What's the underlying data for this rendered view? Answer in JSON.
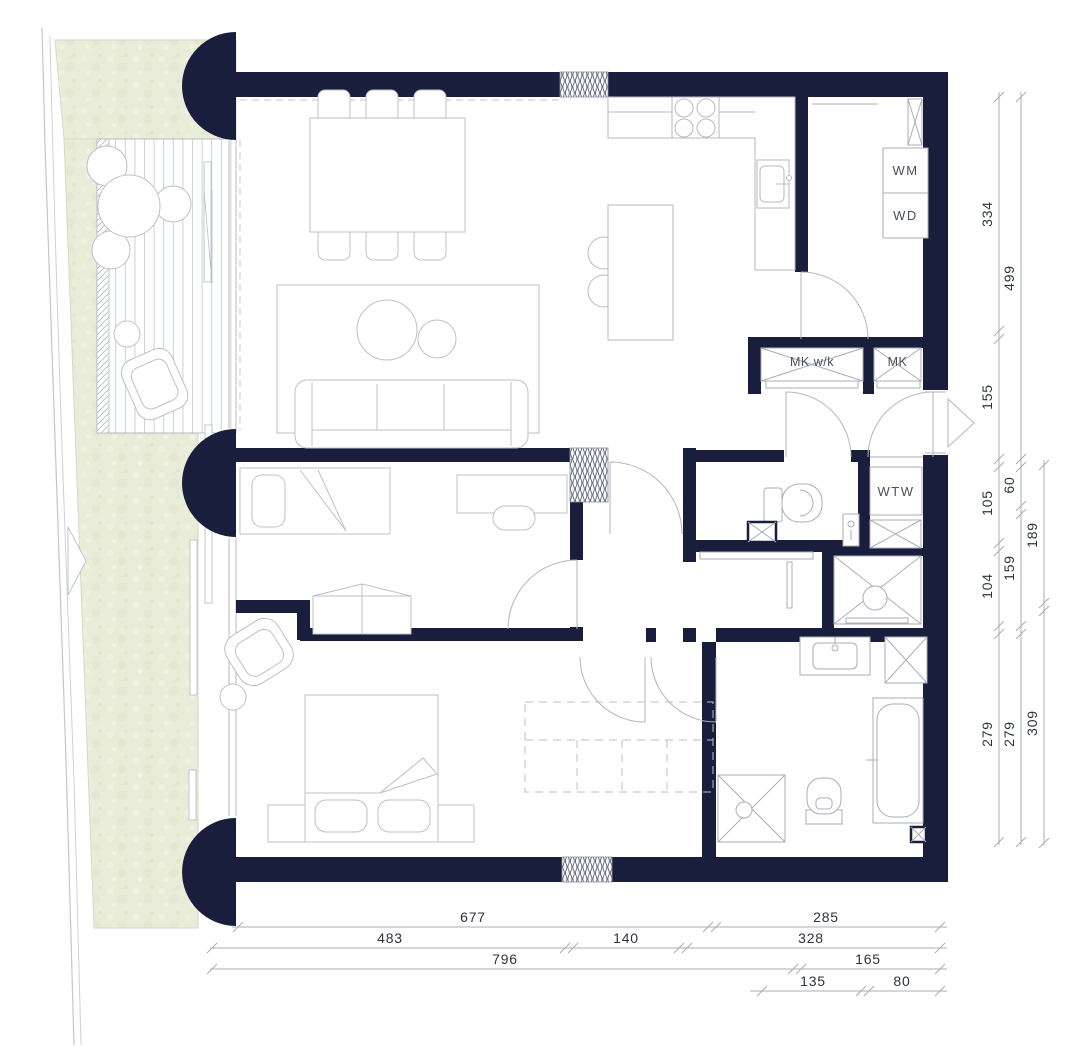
{
  "title": "apartment-floor-plan",
  "colors": {
    "wall": "#191e3c",
    "garden": "#e9ecd8",
    "furniture_line": "#bcc0c8",
    "fixture_line": "#a9aeb8",
    "dim_line": "#a8adb6",
    "dim_text": "#2e333e",
    "label_text": "#4a505c",
    "paper": "#ffffff"
  },
  "appliances": {
    "wm": "WM",
    "wd": "WD",
    "wtw": "WTW"
  },
  "closets": {
    "mk_wk": "MK w/k",
    "mk": "MK"
  },
  "dims": {
    "right_col1": [
      "334",
      "155",
      "105",
      "104",
      "279"
    ],
    "right_col2": [
      "499",
      "60",
      "159",
      "279"
    ],
    "right_col3": [
      "189",
      "309"
    ],
    "bottom_row1": [
      "677",
      "285"
    ],
    "bottom_row2": [
      "483",
      "140",
      "328"
    ],
    "bottom_row3": [
      "796",
      "165"
    ],
    "bottom_row4": [
      "135",
      "80"
    ]
  }
}
